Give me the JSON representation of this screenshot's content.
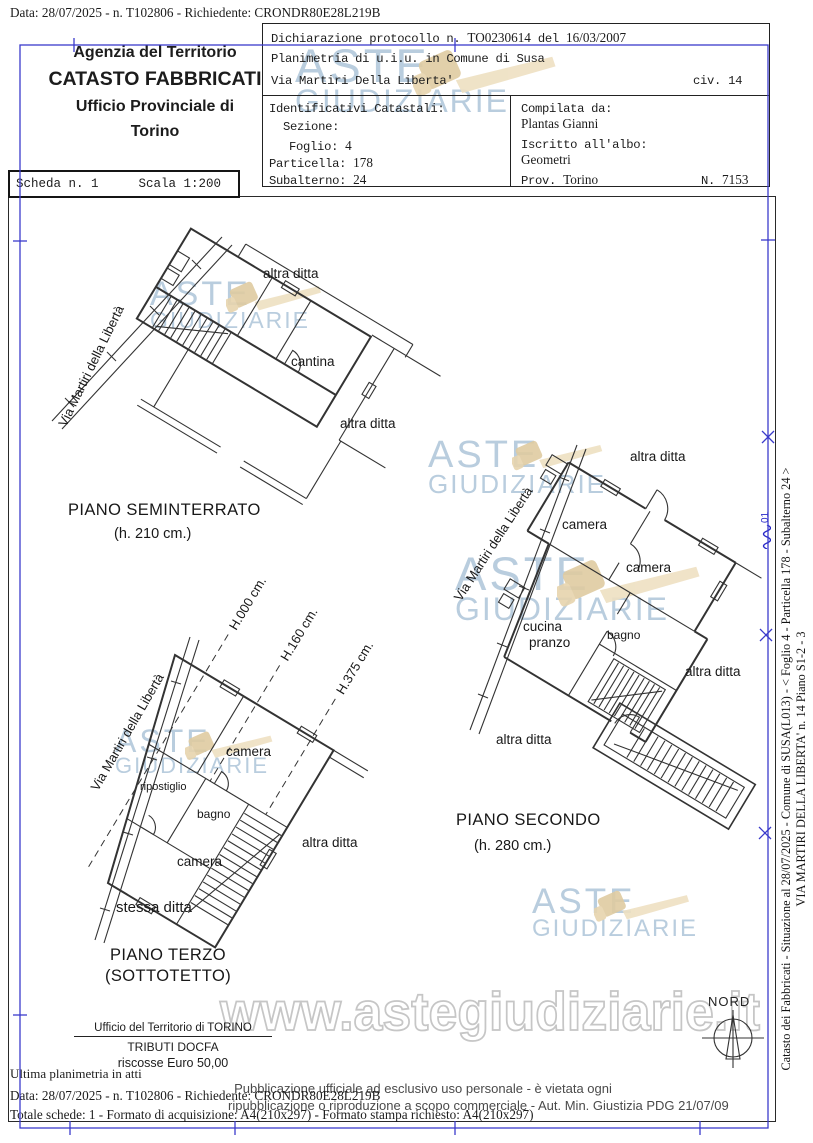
{
  "colors": {
    "frame_blue": "#3b3bcb",
    "plan_ink": "#333333",
    "watermark_blue": "#b9cdde",
    "gavel_tan": "#e9d6b0",
    "outline_gray": "#c6c6c6",
    "footer_gray": "#4a4a4a"
  },
  "page_header": {
    "info_line": "Data: 28/07/2025 - n. T102806 - Richiedente: CRONDR80E28L219B"
  },
  "agency": {
    "line1": "Agenzia del Territorio",
    "line2": "CATASTO FABBRICATI",
    "line3": "Ufficio Provinciale di",
    "line4": "Torino"
  },
  "declaration": {
    "protocol_label": "Dichiarazione protocollo n.",
    "protocol_value": "TO0230614",
    "del_label": "del",
    "protocol_date": "16/03/2007",
    "planimetria_line": "Planimetria di u.i.u. in Comune di Susa",
    "street_line": "Via Martiri Della Liberta'",
    "civ": "civ. 14"
  },
  "identifiers": {
    "title": "Identificativi Catastali:",
    "sezione_label": "Sezione:",
    "foglio_label": "Foglio:",
    "foglio_value": "4",
    "particella_label": "Particella:",
    "particella_value": "178",
    "subalterno_label": "Subalterno:",
    "subalterno_value": "24"
  },
  "compiler": {
    "label": "Compilata da:",
    "name": "Plantas Gianni",
    "albo_label": "Iscritto all'albo:",
    "albo_value": "Geometri",
    "prov_label": "Prov.",
    "prov_value": "Torino",
    "n_label": "N.",
    "n_value": "7153"
  },
  "scheda": {
    "number": "Scheda n. 1",
    "scale": "Scala 1:200"
  },
  "plans": {
    "seminterrato": {
      "title": "PIANO SEMINTERRATO",
      "height": "(h. 210 cm.)",
      "street": "Via Martiri della Libertà",
      "labels": {
        "altra_top": "altra ditta",
        "cantina": "cantina",
        "altra_right": "altra ditta"
      }
    },
    "secondo": {
      "title": "PIANO SECONDO",
      "height": "(h. 280 cm.)",
      "street": "Via Martiri della Libertà",
      "labels": {
        "altra_top": "altra ditta",
        "camera1": "camera",
        "camera2": "camera",
        "cucina1": "cucina",
        "cucina2": "pranzo",
        "bagno": "bagno",
        "altra_right": "altra ditta",
        "altra_bottom": "altra ditta"
      }
    },
    "terzo": {
      "title": "PIANO TERZO",
      "subtitle": "(SOTTOTETTO)",
      "street": "Via Martiri della Libertà",
      "heights": {
        "h0": "H.000 cm.",
        "h160": "H.160 cm.",
        "h375": "H.375 cm."
      },
      "labels": {
        "camera_top": "camera",
        "ripostiglio": "ripostiglio",
        "bagno": "bagno",
        "camera_bottom": "camera",
        "altra_right": "altra ditta",
        "stessa": "stessa ditta"
      }
    }
  },
  "watermark": {
    "line1": "ASTE",
    "line2": "GIUDIZIARIE",
    "url": "www.astegiudiziarie.it"
  },
  "compass": {
    "label": "NORD"
  },
  "office": {
    "line1": "Ufficio del Territorio di TORINO",
    "line2": "TRIBUTI DOCFA",
    "line3": "riscosse Euro 50,00"
  },
  "footer": {
    "atti": "Ultima planimetria in atti",
    "data_line": "Data: 28/07/2025 - n. T102806 - Richiedente: CRONDR80E28L219B",
    "totale_line": "Totale schede: 1 - Formato di acquisizione: A4(210x297) - Formato stampa richiesto: A4(210x297)",
    "pub1": "Pubblicazione ufficiale ad esclusivo uso personale - è vietata ogni",
    "pub2": "ripubblicazione o riproduzione a scopo commerciale - Aut. Min. Giustizia PDG 21/07/09"
  },
  "side_caption": {
    "line1": "Catasto dei Fabbricati - Situazione al 28/07/2025 - Comune di SUSA(L013) - <  Foglio 4 - Particella 178 - Subalterno 24 >",
    "line2": "VIA MARTIRI DELLA LIBERTA'  n. 14 Piano S1-2 - 3",
    "stamp": "01"
  }
}
